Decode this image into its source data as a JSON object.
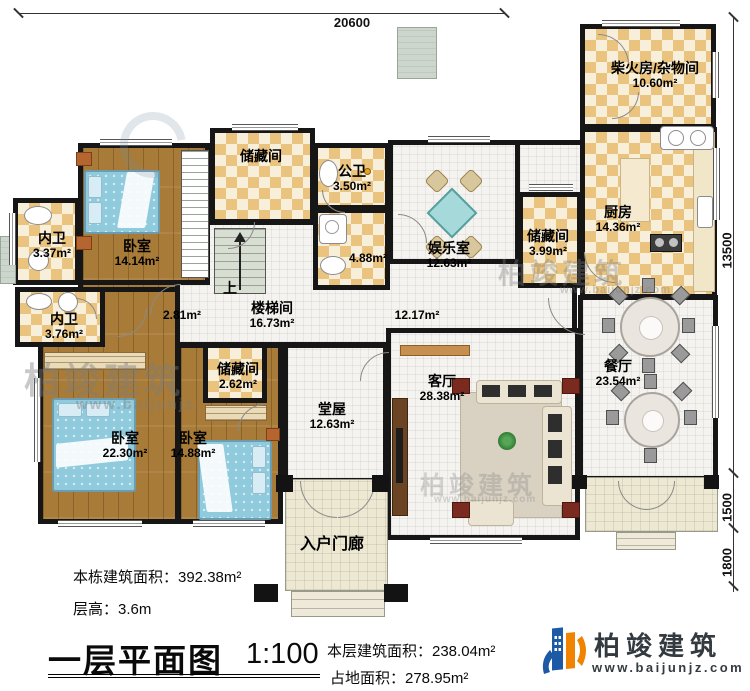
{
  "dimensions": {
    "top": "20600",
    "right_upper": "13500",
    "right_mid": "1500",
    "right_lower": "1800"
  },
  "rooms": {
    "bedroom_a": {
      "name": "卧室",
      "area": "14.14m²"
    },
    "neiwei_1": {
      "name": "内卫",
      "area": "3.37m²"
    },
    "storage_top": {
      "name": "储藏间"
    },
    "gongwei": {
      "name": "公卫",
      "area": "3.50m²"
    },
    "shower": {
      "area": "4.88m²"
    },
    "yuleshi": {
      "name": "娱乐室",
      "area": "12.63m²"
    },
    "chaihuofang": {
      "name": "柴火房/杂物间",
      "area": "10.60m²"
    },
    "kitchen": {
      "name": "厨房",
      "area": "14.36m²"
    },
    "storage_right": {
      "name": "储藏间",
      "area": "3.99m²"
    },
    "neiwei_2": {
      "name": "内卫",
      "area": "3.76m²"
    },
    "stair_hall": {
      "name": "楼梯间",
      "area": "16.73m²"
    },
    "hall_small": {
      "area": "2.81m²"
    },
    "hall_main": {
      "area": "12.17m²"
    },
    "storage_small": {
      "name": "储藏间",
      "area": "2.62m²"
    },
    "bedroom_b": {
      "name": "卧室",
      "area": "22.30m²"
    },
    "bedroom_c": {
      "name": "卧室",
      "area": "14.88m²"
    },
    "tangwu": {
      "name": "堂屋",
      "area": "12.63m²"
    },
    "keting": {
      "name": "客厅",
      "area": "28.38m²"
    },
    "canting": {
      "name": "餐厅",
      "area": "23.54m²"
    },
    "porch": {
      "name": "入户门廊"
    }
  },
  "stairs": {
    "up_label": "上"
  },
  "watermarks": {
    "brand": "柏竣建筑",
    "site": "www.baijunjz.com",
    "site_short": "www.baijunjz."
  },
  "footer": {
    "total_area": "本栋建筑面积：392.38m²",
    "floor_height": "层高：3.6m",
    "plan_title": "一层平面图",
    "scale": "1:100",
    "floor_area": "本层建筑面积：238.04m²",
    "footprint": "占地面积：278.95m²"
  },
  "logo": {
    "brand": "柏竣建筑",
    "site": "www.baijunjz.com"
  },
  "colors": {
    "wall": "#161616",
    "checker_tan": "#eac47e",
    "wood": "#a87c38",
    "bed_blue": "#8fcadd",
    "logo_blue": "#1c5aa6",
    "logo_orange": "#f08300",
    "watermark_gray": "#7d7d7d"
  }
}
